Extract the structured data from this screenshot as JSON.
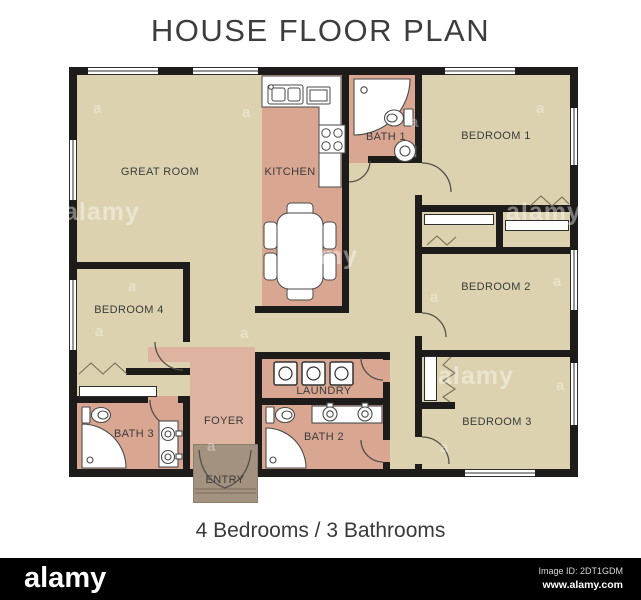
{
  "header": {
    "title": "HOUSE FLOOR PLAN"
  },
  "caption": {
    "text": "4 Bedrooms / 3 Bathrooms"
  },
  "rooms": [
    {
      "label": "GREAT ROOM"
    },
    {
      "label": "KITCHEN"
    },
    {
      "label": "BATH 1"
    },
    {
      "label": "BEDROOM 1"
    },
    {
      "label": "BEDROOM 2"
    },
    {
      "label": "BEDROOM 4"
    },
    {
      "label": "LAUNDRY"
    },
    {
      "label": "FOYER"
    },
    {
      "label": "BATH 3"
    },
    {
      "label": "BATH 2"
    },
    {
      "label": "BEDROOM 3"
    },
    {
      "label": "ENTRY"
    }
  ],
  "watermark": {
    "logo_text": "alamy",
    "letter": "a"
  },
  "footer": {
    "logo_text": "alamy",
    "image_id": "Image ID: 2DT1GDM",
    "url": "www.alamy.com"
  },
  "colors": {
    "wall": "#1e1c1a",
    "room_tan": "#dcd2af",
    "room_salmon": "#d9a692",
    "room_salmon_light": "#deb4a0",
    "entry_brown": "#a39280",
    "fixture_white": "#ffffff",
    "footer_bg": "#000000"
  }
}
